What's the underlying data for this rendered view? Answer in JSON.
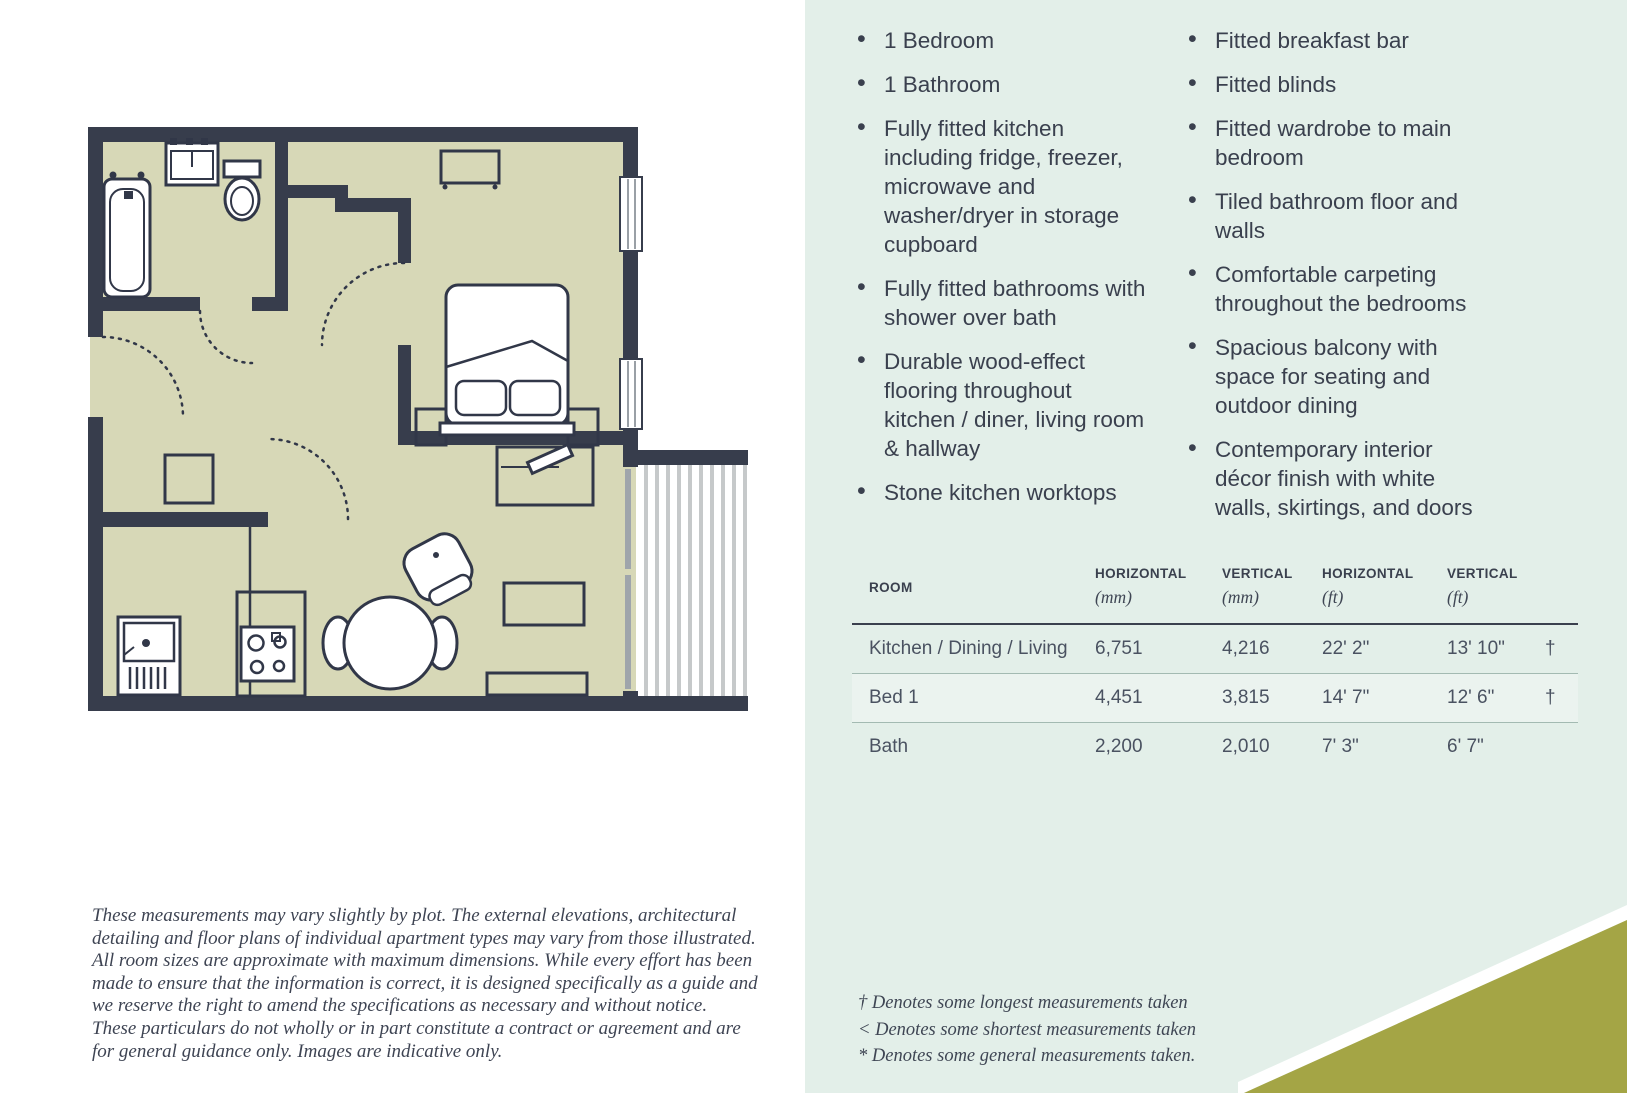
{
  "colors": {
    "panel_mint": "#e3efe9",
    "accent_olive": "#a4a545",
    "wall_dark": "#373d4c",
    "floor_khaki": "#d7d8b7",
    "text_dark": "#3a404e"
  },
  "features": {
    "left": [
      "1 Bedroom",
      "1 Bathroom",
      "Fully fitted kitchen including fridge, freezer, microwave and washer/dryer in storage cupboard",
      "Fully fitted bathrooms with shower over bath",
      "Durable wood-effect flooring throughout kitchen / diner, living room & hallway",
      "Stone kitchen worktops"
    ],
    "right": [
      "Fitted breakfast bar",
      "Fitted blinds",
      "Fitted wardrobe to main bedroom",
      "Tiled bathroom floor and walls",
      "Comfortable carpeting throughout the bedrooms",
      "Spacious balcony with space for seating and outdoor dining",
      "Contemporary interior décor finish with white walls, skirtings, and doors"
    ]
  },
  "table": {
    "headers": [
      {
        "label": "ROOM",
        "unit": ""
      },
      {
        "label": "HORIZONTAL",
        "unit": "(mm)"
      },
      {
        "label": "VERTICAL",
        "unit": "(mm)"
      },
      {
        "label": "HORIZONTAL",
        "unit": "(ft)"
      },
      {
        "label": "VERTICAL",
        "unit": "(ft)"
      }
    ],
    "rows": [
      {
        "room": "Kitchen / Dining / Living",
        "h_mm": "6,751",
        "v_mm": "4,216",
        "h_ft": "22' 2\"",
        "v_ft": "13' 10\"",
        "note": "†"
      },
      {
        "room": "Bed 1",
        "h_mm": "4,451",
        "v_mm": "3,815",
        "h_ft": "14' 7\"",
        "v_ft": "12' 6\"",
        "note": "†"
      },
      {
        "room": "Bath",
        "h_mm": "2,200",
        "v_mm": "2,010",
        "h_ft": "7' 3\"",
        "v_ft": "6' 7\"",
        "note": ""
      }
    ]
  },
  "disclaimer": {
    "p1": "These measurements may vary slightly by plot. The external elevations, architectural detailing and floor plans of individual apartment types may vary from those illustrated. All room sizes are approximate with maximum dimensions. While every effort has been made to ensure that the information is correct, it is designed specifically as a guide and we reserve the right to amend the specifications as necessary and without notice.",
    "p2": "These particulars do not wholly or in part constitute a contract or agreement and are for general guidance only. Images are indicative only."
  },
  "footnotes": [
    "† Denotes some longest measurements taken",
    "< Denotes some shortest measurements taken",
    "* Denotes some general measurements taken."
  ]
}
